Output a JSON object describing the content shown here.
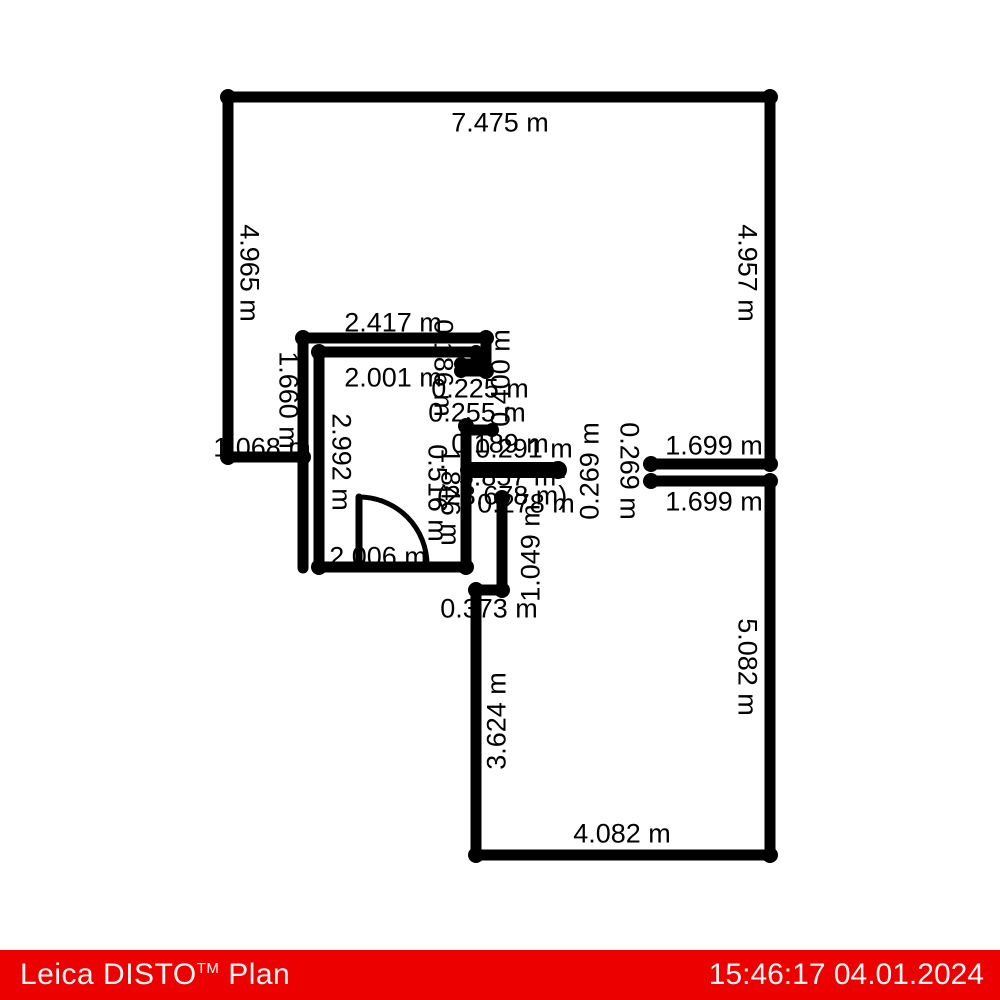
{
  "footer": {
    "app_name": "Leica DISTO",
    "tm": "TM",
    "app_suffix": " Plan",
    "timestamp": "15:46:17 04.01.2024",
    "bar_color": "#ec0000",
    "text_color": "#f7f4f4"
  },
  "floorplan": {
    "wall_color": "#000000",
    "unit": "m",
    "area_label": "5.857 m²",
    "perimeter_label": "(23.678 m)",
    "labels": [
      {
        "text": "7.475 m",
        "x": 500,
        "y": 123,
        "rot": 0
      },
      {
        "text": "4.965 m",
        "x": 249,
        "y": 273,
        "rot": 90
      },
      {
        "text": "4.957 m",
        "x": 747,
        "y": 273,
        "rot": 90
      },
      {
        "text": "2.417 m",
        "x": 393,
        "y": 323,
        "rot": 0
      },
      {
        "text": "2.001 m",
        "x": 393,
        "y": 378,
        "rot": 0
      },
      {
        "text": "1.660 m",
        "x": 288,
        "y": 400,
        "rot": 90
      },
      {
        "text": "1.068 m",
        "x": 262,
        "y": 448,
        "rot": 0
      },
      {
        "text": "2.992 m",
        "x": 341,
        "y": 462,
        "rot": 90
      },
      {
        "text": "0.225 m",
        "x": 480,
        "y": 389,
        "rot": 0
      },
      {
        "text": "0.255 m",
        "x": 477,
        "y": 413,
        "rot": 0
      },
      {
        "text": "0.186 m",
        "x": 443,
        "y": 368,
        "rot": 90
      },
      {
        "text": "0.400 m",
        "x": 501,
        "y": 378,
        "rot": -90
      },
      {
        "text": "0.189 m",
        "x": 500,
        "y": 444,
        "rot": 0
      },
      {
        "text": "0.291 m",
        "x": 524,
        "y": 449,
        "rot": 0
      },
      {
        "text": "5.857 m²",
        "x": 512,
        "y": 477,
        "rot": 0
      },
      {
        "text": "(23.678 m)",
        "x": 502,
        "y": 496,
        "rot": 0
      },
      {
        "text": "0.278 m",
        "x": 526,
        "y": 504,
        "rot": 0
      },
      {
        "text": "0.516 m",
        "x": 437,
        "y": 493,
        "rot": 90
      },
      {
        "text": "1.846 m",
        "x": 450,
        "y": 497,
        "rot": 90
      },
      {
        "text": "2.006 m",
        "x": 378,
        "y": 557,
        "rot": 0
      },
      {
        "text": "1.049 m",
        "x": 531,
        "y": 553,
        "rot": -90
      },
      {
        "text": "0.373 m",
        "x": 489,
        "y": 609,
        "rot": 0
      },
      {
        "text": "0.269 m",
        "x": 590,
        "y": 471,
        "rot": -90
      },
      {
        "text": "0.269 m",
        "x": 629,
        "y": 471,
        "rot": 90
      },
      {
        "text": "1.699 m",
        "x": 714,
        "y": 446,
        "rot": 0
      },
      {
        "text": "1.699 m",
        "x": 714,
        "y": 502,
        "rot": 0
      },
      {
        "text": "3.624 m",
        "x": 497,
        "y": 721,
        "rot": -90
      },
      {
        "text": "5.082 m",
        "x": 747,
        "y": 667,
        "rot": 90
      },
      {
        "text": "4.082 m",
        "x": 622,
        "y": 834,
        "rot": 0
      }
    ]
  }
}
